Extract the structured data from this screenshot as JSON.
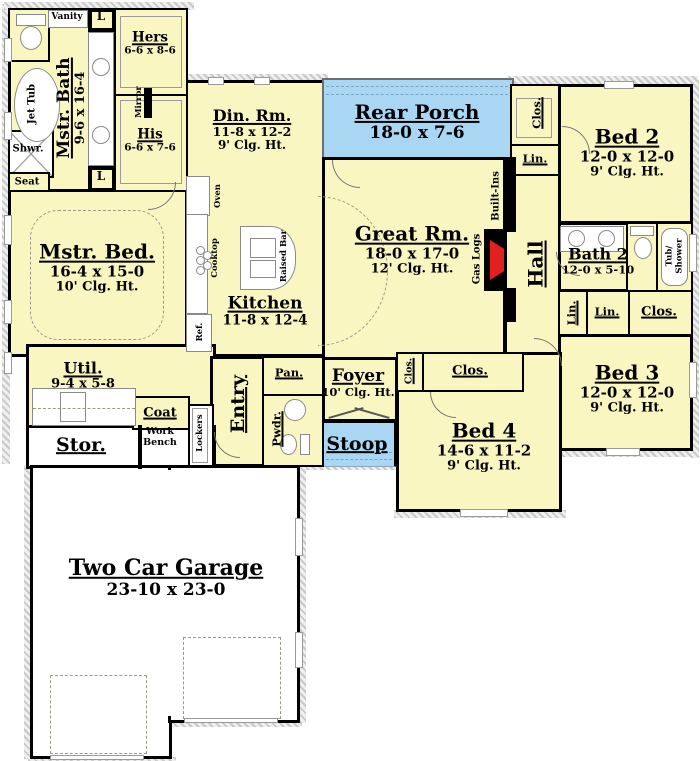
{
  "title": "Four bedroom house first-floor plan",
  "colors": {
    "floor": "#FAF6C2",
    "porch": "#A9D6F2",
    "wall": "#000000",
    "fire": "#E32020"
  },
  "rooms": {
    "mstr_bath": {
      "name": "Mstr. Bath",
      "dims": "9-6 x 16-4"
    },
    "hers": {
      "name": "Hers",
      "dims": "6-6 x 8-6"
    },
    "his": {
      "name": "His",
      "dims": "6-6 x 7-6"
    },
    "din": {
      "name": "Din. Rm.",
      "dims": "11-8 x 12-2",
      "clg": "9' Clg. Ht."
    },
    "rear_porch": {
      "name": "Rear Porch",
      "dims": "18-0 x 7-6"
    },
    "bed2": {
      "name": "Bed 2",
      "dims": "12-0 x 12-0",
      "clg": "9' Clg. Ht."
    },
    "mstr_bed": {
      "name": "Mstr. Bed.",
      "dims": "16-4 x 15-0",
      "clg": "10' Clg. Ht."
    },
    "great": {
      "name": "Great Rm.",
      "dims": "18-0 x 17-0",
      "clg": "12' Clg. Ht."
    },
    "kitchen": {
      "name": "Kitchen",
      "dims": "11-8 x 12-4"
    },
    "hall": {
      "name": "Hall"
    },
    "bath2": {
      "name": "Bath 2",
      "dims": "12-0 x 5-10"
    },
    "bed3": {
      "name": "Bed 3",
      "dims": "12-0 x 12-0",
      "clg": "9' Clg. Ht."
    },
    "bed4": {
      "name": "Bed 4",
      "dims": "14-6 x 11-2",
      "clg": "9' Clg. Ht."
    },
    "foyer": {
      "name": "Foyer",
      "clg": "10' Clg. Ht."
    },
    "stoop": {
      "name": "Stoop"
    },
    "entry": {
      "name": "Entry"
    },
    "util": {
      "name": "Util.",
      "dims": "9-4 x 5-8"
    },
    "stor": {
      "name": "Stor."
    },
    "garage": {
      "name": "Two Car Garage",
      "dims": "23-10 x 23-0"
    }
  },
  "fixtures": {
    "vanity": "Vanity",
    "closet_l": "L",
    "jet_tub": "Jet Tub",
    "shwr": "Shwr.",
    "seat": "Seat",
    "mirror": "Mirror",
    "oven": "Oven",
    "cooktop": "Cooktop",
    "ref": "Ref.",
    "raised_bar": "Raised Bar",
    "built_ins": "Built-Ins",
    "gas_logs": "Gas Logs",
    "tub_shower_l1": "Tub/",
    "tub_shower_l2": "Shower",
    "coat": "Coat",
    "work_bench": "Work Bench",
    "lockers": "Lockers",
    "pan": "Pan.",
    "pwdr": "Pwdr.",
    "clos": "Clos.",
    "lin": "Lin."
  }
}
